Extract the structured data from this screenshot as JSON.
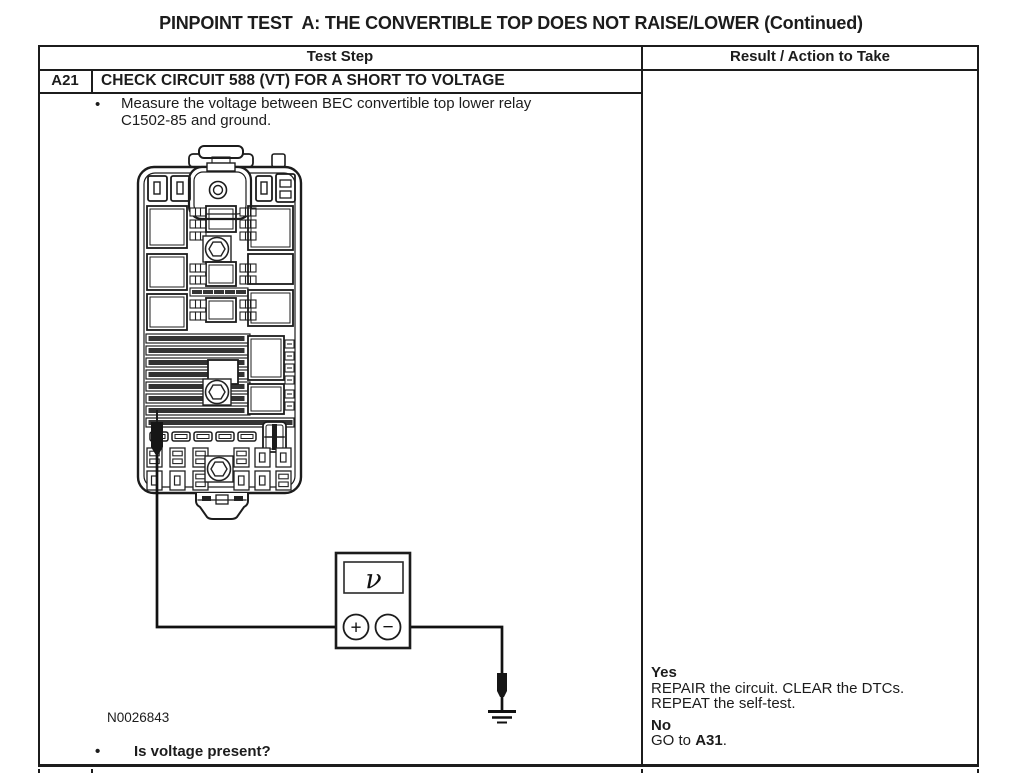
{
  "page_title": "PINPOINT TEST  A: THE CONVERTIBLE TOP DOES NOT RAISE/LOWER (Continued)",
  "bullet_char": "•",
  "table": {
    "header": {
      "test_step": "Test Step",
      "result_action": "Result / Action to Take"
    },
    "step": {
      "id": "A21",
      "title": "CHECK CIRCUIT 588 (VT) FOR A SHORT TO VOLTAGE",
      "instruction": "Measure the voltage between BEC convertible top lower relay C1502-85 and ground.",
      "question": "Is voltage present?"
    },
    "result": {
      "yes_label": "Yes",
      "yes_line1": "REPAIR the circuit. CLEAR the DTCs.",
      "yes_line2": "REPEAT the self-test.",
      "no_label": "No",
      "no_prefix": "GO to ",
      "no_step": "A31",
      "no_suffix": "."
    }
  },
  "figure": {
    "id_label": "N0026843",
    "voltmeter_symbol": "ν",
    "plus_symbol": "+",
    "minus_symbol": "−"
  }
}
